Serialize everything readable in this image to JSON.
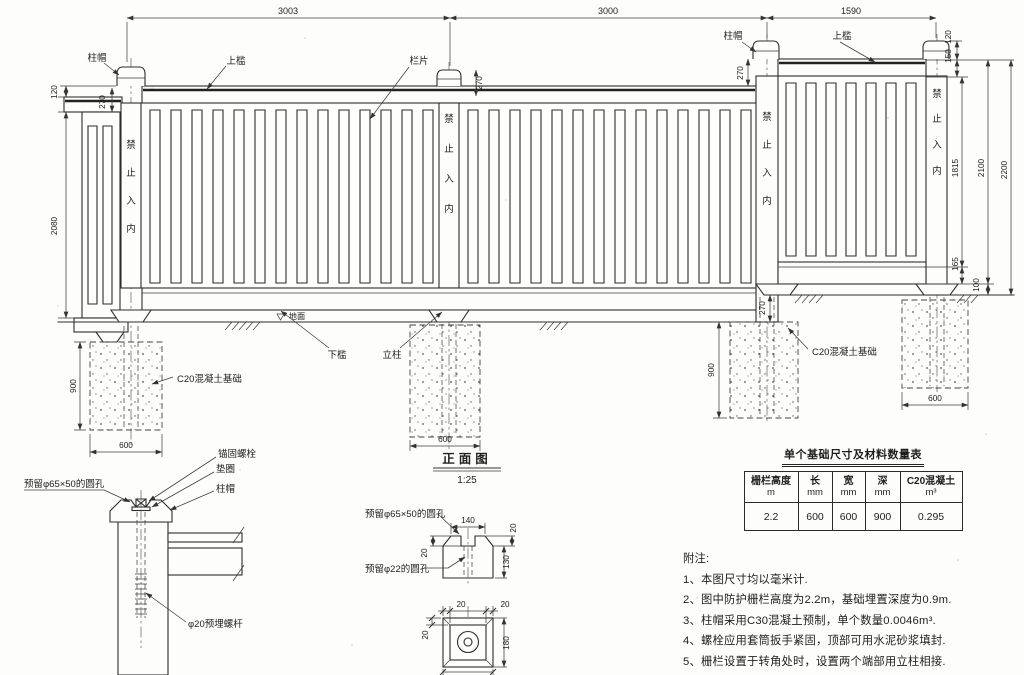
{
  "drawing": {
    "view_title": "正面图",
    "view_scale": "1:25",
    "no_entry": [
      "禁",
      "止",
      "入",
      "内"
    ],
    "labels": {
      "post_cap": "柱帽",
      "top_rail": "上槛",
      "rail_panel": "栏片",
      "bottom_rail": "下槛",
      "post": "立柱",
      "ground": "地面",
      "c20_foundation": "C20混凝土基础",
      "anchor_bolt": "锚固螺栓",
      "washer": "垫圈",
      "hole_65x50": "预留φ65×50的圆孔",
      "hole_22": "预留φ22的圆孔",
      "embed_rod": "φ20预埋螺杆"
    },
    "dims": {
      "bay1": "3003",
      "bay2": "3000",
      "bay3": "1590",
      "rail_h": "120",
      "cap_h": "270",
      "panel_h": "2080",
      "cap_top": "150",
      "inner_h": "1815",
      "kick": "165",
      "rail_to_ground": "2100",
      "base": "100",
      "total_h": "2200",
      "found_d": "900",
      "found_w": "600",
      "capd_w": "140",
      "capd_h": "130",
      "capd_t": "20",
      "plan_s": "180"
    }
  },
  "table": {
    "title": "单个基础尺寸及材料数量表",
    "headers": [
      {
        "label": "栅栏高度",
        "unit": "m"
      },
      {
        "label": "长",
        "unit": "mm"
      },
      {
        "label": "宽",
        "unit": "mm"
      },
      {
        "label": "深",
        "unit": "mm"
      },
      {
        "label": "C20混凝土",
        "unit": "m³"
      }
    ],
    "row": [
      "2.2",
      "600",
      "600",
      "900",
      "0.295"
    ]
  },
  "notes": {
    "title": "附注:",
    "items": [
      "1、本图尺寸均以毫米计.",
      "2、图中防护栅栏高度为2.2m，基础埋置深度为0.9m.",
      "3、柱帽采用C30混凝土预制，单个数量0.0046m³.",
      "4、螺栓应用套筒扳手紧固，顶部可用水泥砂浆填封.",
      "5、栅栏设置于转角处时，设置两个端部用立柱相接."
    ]
  }
}
